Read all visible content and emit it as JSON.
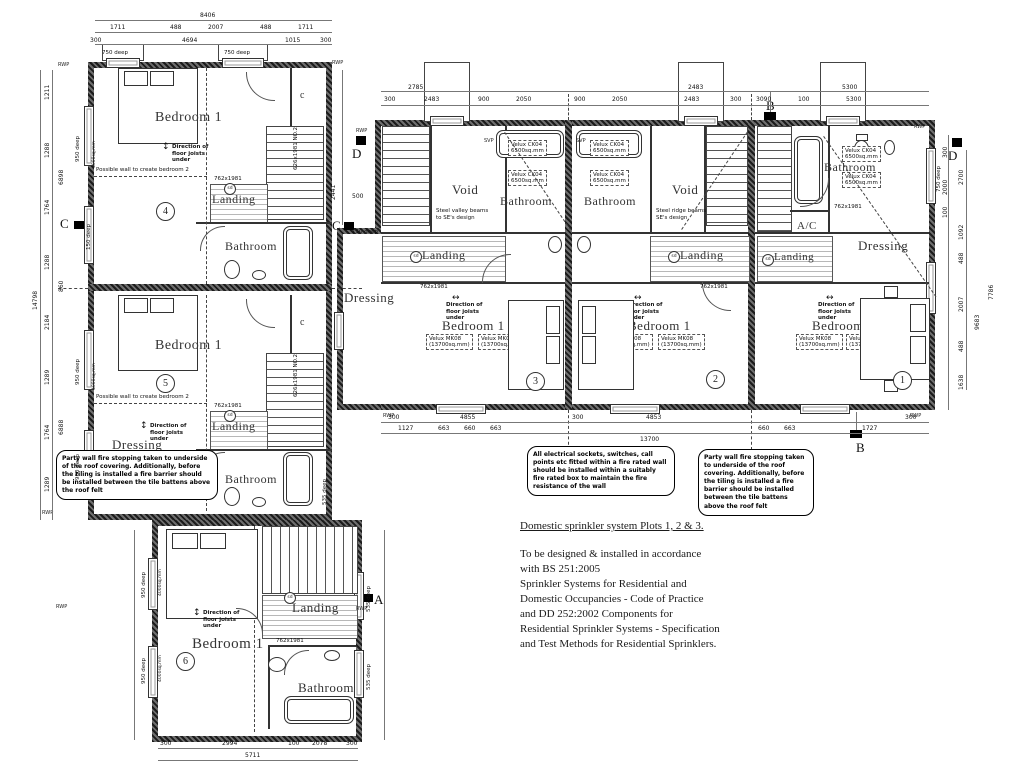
{
  "rooms": {
    "bedroom": "Bedroom 1",
    "landing": "Landing",
    "bathroom": "Bathroom",
    "dressing": "Dressing",
    "voidroom": "Void",
    "ac": "A/C",
    "cupboard": "c"
  },
  "plots": {
    "n1": "1",
    "n2": "2",
    "n3": "3",
    "n4": "4",
    "n5": "5",
    "n6": "6"
  },
  "ann": {
    "joists": "Direction of floor joists under",
    "possible_wall": "Possible wall to create bedroom 2",
    "steel_valley": "Steel valley beams to SE's design",
    "steel_ridge": "Steel ridge beams to SE's design",
    "door762": "762x1981",
    "door762fd": "762x1981 FD",
    "door626": "626x1981 NO.2",
    "velux_mk": "Velux MK08",
    "velux_ck": "Velux CK04",
    "sq_bed": "(13700sq.mm)",
    "sq_bath": "6500sq.mm",
    "sq_vent": "4000sq.mm",
    "sd": "sd",
    "rwp": "RWP",
    "svp": "SVP",
    "deep750": "750 deep",
    "deep950": "950 deep",
    "deep535": "535 deep",
    "deep150": "150 deep"
  },
  "markers": {
    "a": "A",
    "b": "B",
    "c": "C",
    "d": "D"
  },
  "clouds": {
    "electrical": "All electrical sockets, switches, call points etc fitted within a fire rated wall should be installed within a suitably fire rated box to maintain the fire resistance of the wall",
    "party": "Party wall fire stopping taken to underside of the roof covering. Additionally, before the tiling is installed a fire barrier should be installed between the tile battens above the roof felt"
  },
  "sprinkler": {
    "heading": "Domestic sprinkler system Plots 1, 2 & 3.",
    "l1": "To be designed & installed in accordance",
    "l2": "with BS 251:2005",
    "l3": "Sprinkler Systems for Residential and",
    "l4": "Domestic Occupancies - Code of Practice",
    "l5": "and DD 252:2002 Components for",
    "l6": "Residential Sprinkler Systems - Specification",
    "l7": "and Test Methods for Residential Sprinklers."
  },
  "dims": {
    "top": [
      "8406",
      "1711",
      "488",
      "2007",
      "488",
      "1711",
      "300",
      "4694",
      "1015",
      "300"
    ],
    "rtop": [
      "2785",
      "2483",
      "5300",
      "300",
      "2483",
      "900",
      "2050",
      "900",
      "2050",
      "2483",
      "300",
      "3090",
      "100",
      "5300"
    ],
    "rbot": [
      "300",
      "4855",
      "300",
      "4853",
      "300",
      "1127",
      "663",
      "660",
      "663",
      "660",
      "663",
      "1727",
      "13700"
    ],
    "lft": [
      "14798",
      "6898",
      "6888",
      "1211",
      "1288",
      "1764",
      "1288",
      "2184",
      "860",
      "1289",
      "1764",
      "1289"
    ],
    "rgt": [
      "300",
      "2000",
      "100",
      "2700",
      "1092",
      "488",
      "2007",
      "488",
      "1638",
      "9683",
      "7786"
    ],
    "p6": [
      "5711",
      "300",
      "2994",
      "100",
      "2078",
      "300"
    ],
    "misc": [
      "2441",
      "500"
    ]
  }
}
